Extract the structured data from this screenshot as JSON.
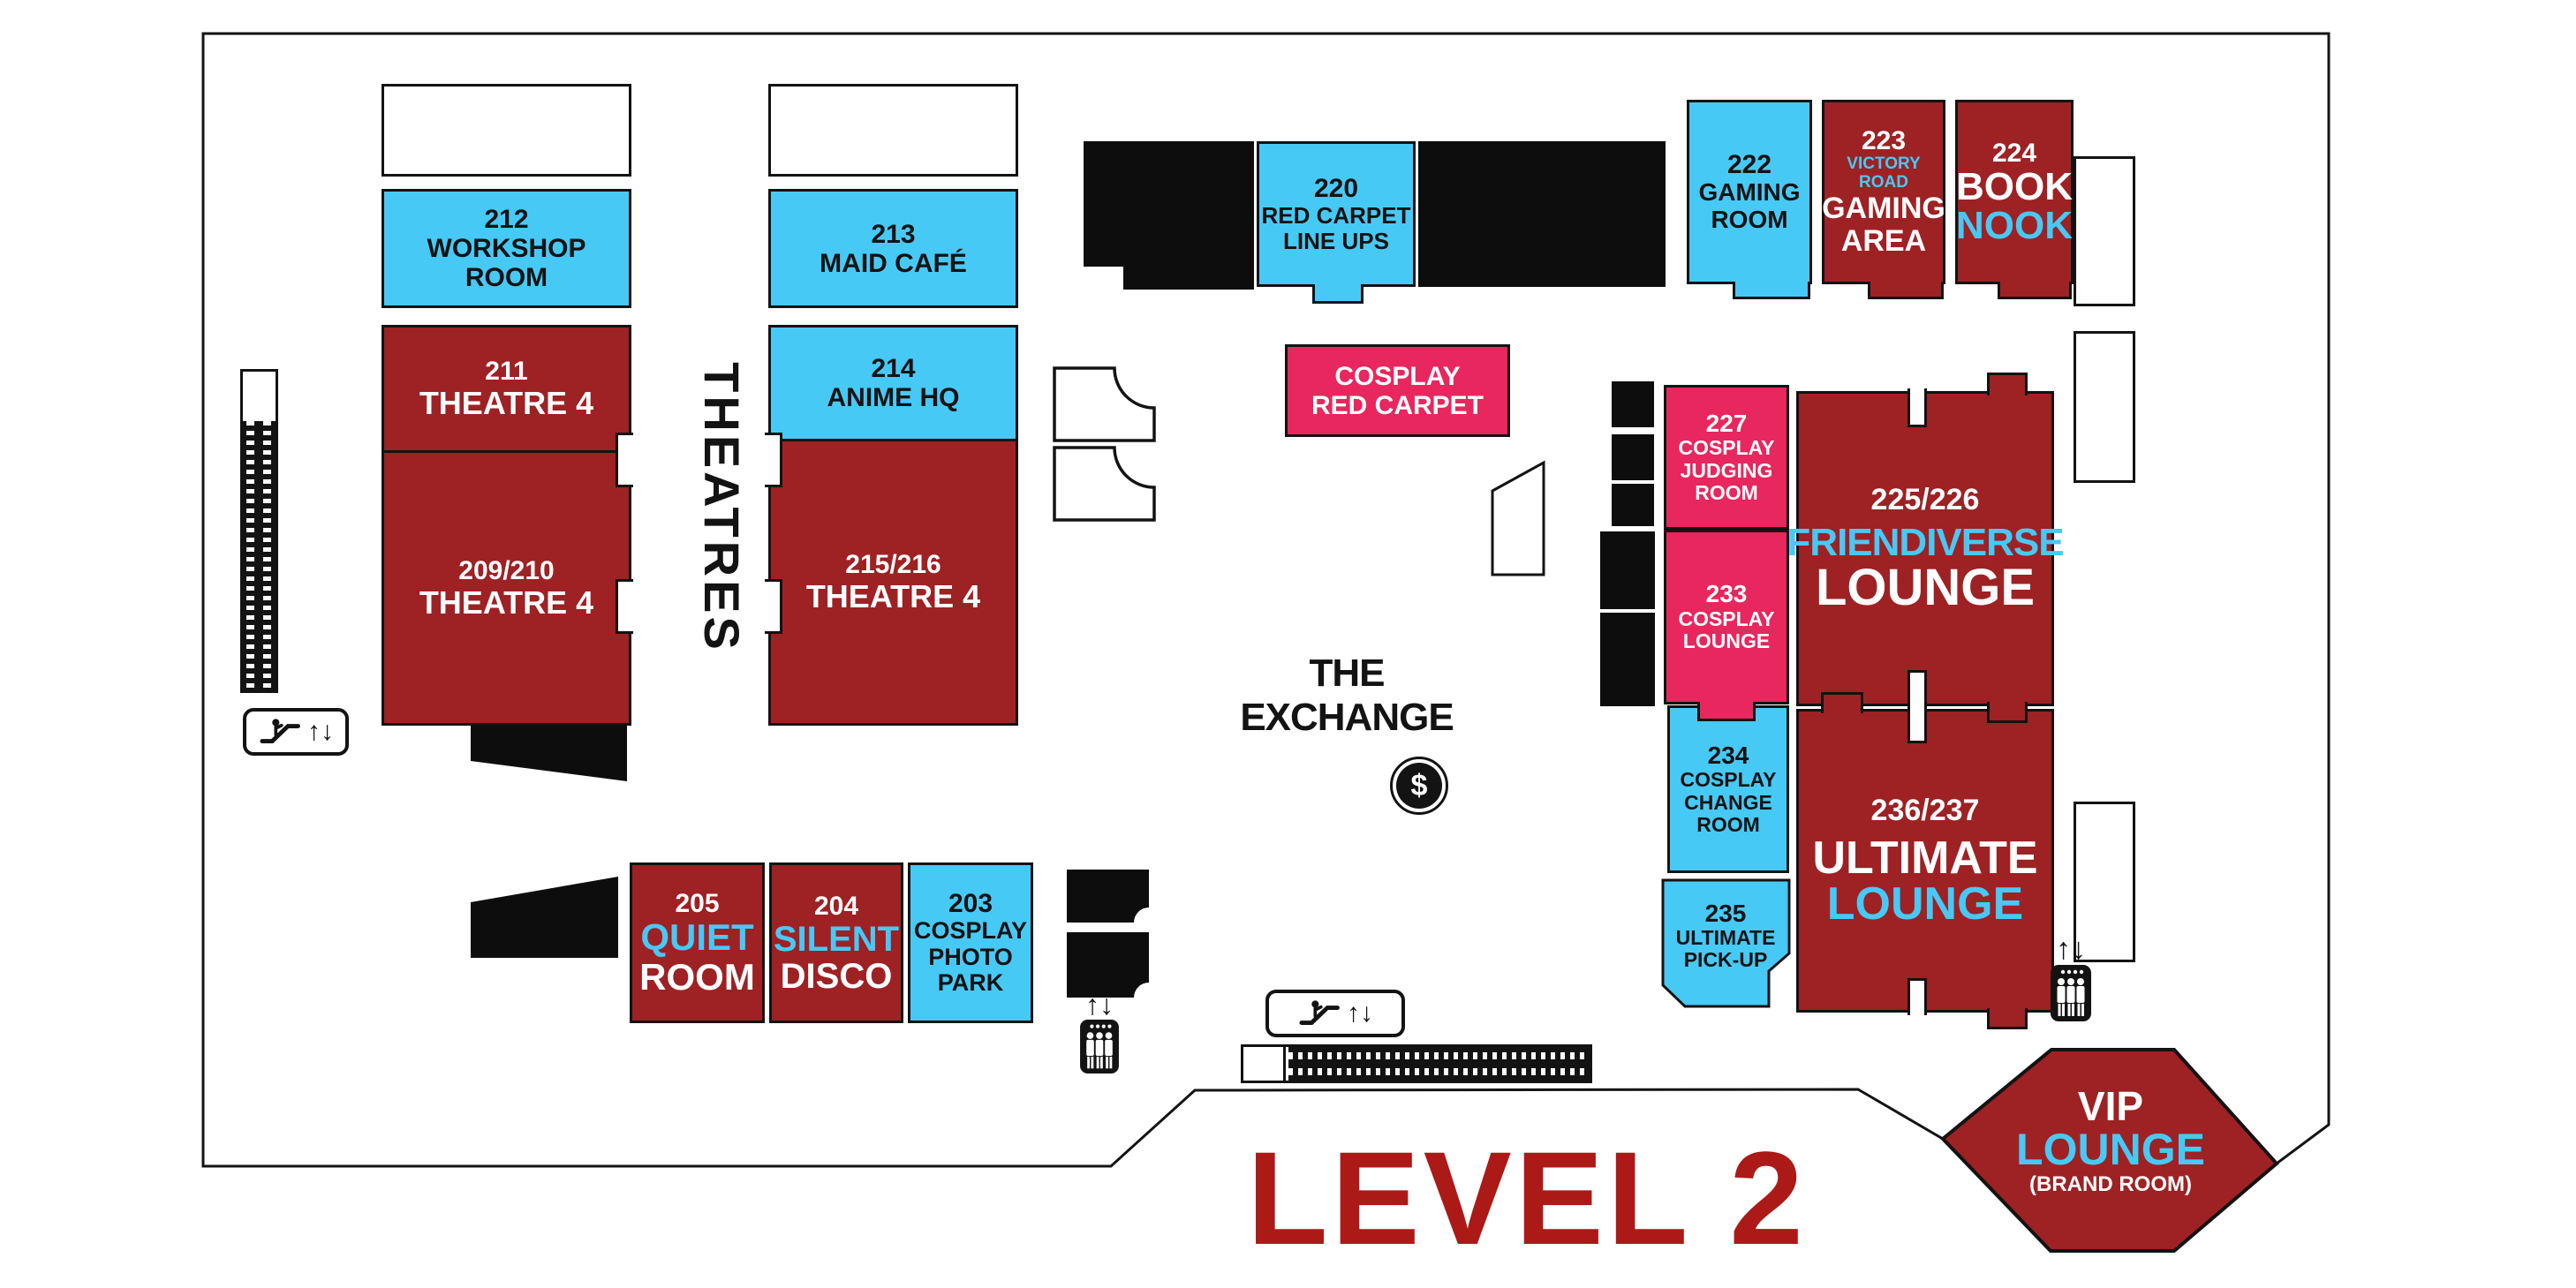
{
  "title": {
    "text": "LEVEL 2"
  },
  "labels": {
    "theatres": "THEATRES",
    "exchange": "THE EXCHANGE",
    "updown_arrows": "↑↓",
    "dollar": "$"
  },
  "palette": {
    "room_blue": "#47C9F6",
    "room_dark_red": "#9E2124",
    "room_pink": "#E7275D",
    "level_title_red": "#AB1A17",
    "line_black": "#131313",
    "text_white": "#FFFFFF"
  },
  "rooms": {
    "r212": {
      "num": "212",
      "name1": "WORKSHOP ROOM"
    },
    "r213": {
      "num": "213",
      "name1": "MAID CAFÉ"
    },
    "r214": {
      "num": "214",
      "name1": "ANIME HQ"
    },
    "r211": {
      "num": "211",
      "name1": "THEATRE 4"
    },
    "r209_210": {
      "num": "209/210",
      "name1": "THEATRE 4"
    },
    "r215_216": {
      "num": "215/216",
      "name1": "THEATRE 4"
    },
    "r220": {
      "num": "220",
      "name1": "RED CARPET",
      "name2": "LINE UPS"
    },
    "r222": {
      "num": "222",
      "name1": "GAMING",
      "name2": "ROOM"
    },
    "r223": {
      "num": "223",
      "sub": "VICTORY ROAD",
      "name1": "GAMING",
      "name2": "AREA"
    },
    "r224": {
      "num": "224",
      "name1": "BOOK",
      "name2": "NOOK"
    },
    "cosplay_red_carpet": {
      "name1": "COSPLAY",
      "name2": "RED CARPET"
    },
    "r227": {
      "num": "227",
      "name1": "COSPLAY",
      "name2": "JUDGING",
      "name3": "ROOM"
    },
    "r233": {
      "num": "233",
      "name1": "COSPLAY",
      "name2": "LOUNGE"
    },
    "r225_226": {
      "num": "225/226",
      "name1": "FRIENDIVERSE",
      "name2": "LOUNGE"
    },
    "r234": {
      "num": "234",
      "name1": "COSPLAY",
      "name2": "CHANGE",
      "name3": "ROOM"
    },
    "r235": {
      "num": "235",
      "name1": "ULTIMATE",
      "name2": "PICK-UP"
    },
    "r236_237": {
      "num": "236/237",
      "name1": "ULTIMATE",
      "name2": "LOUNGE"
    },
    "r205": {
      "num": "205",
      "name1": "QUIET",
      "name2": "ROOM"
    },
    "r204": {
      "num": "204",
      "name1": "SILENT",
      "name2": "DISCO"
    },
    "r203": {
      "num": "203",
      "name1": "COSPLAY",
      "name2": "PHOTO",
      "name3": "PARK"
    },
    "vip": {
      "name1": "VIP",
      "name2": "LOUNGE",
      "name3": "(BRAND ROOM)"
    }
  }
}
